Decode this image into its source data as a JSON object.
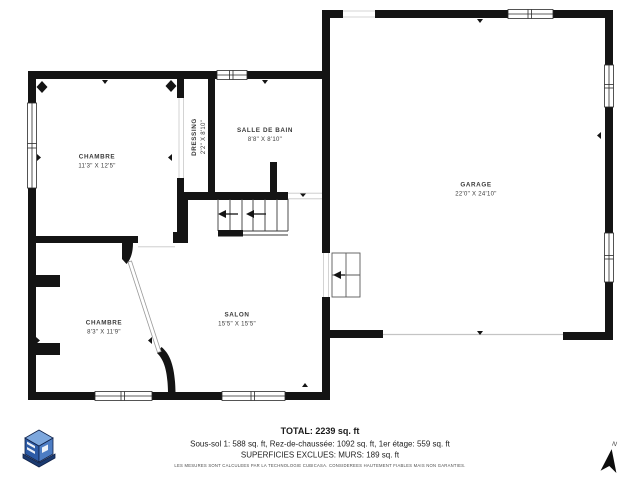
{
  "floorplan": {
    "rooms": [
      {
        "name": "CHAMBRE",
        "dims": "11'3\" X 12'5\""
      },
      {
        "name": "DRESSING",
        "dims": "2'2\" X 8'10\""
      },
      {
        "name": "SALLE DE BAIN",
        "dims": "8'8\" X 8'10\""
      },
      {
        "name": "GARAGE",
        "dims": "22'0\" X 24'10\""
      },
      {
        "name": "CHAMBRE",
        "dims": "8'3\" X 11'9\""
      },
      {
        "name": "SALON",
        "dims": "15'5\" X 15'5\""
      }
    ],
    "compass": {
      "label": "N"
    }
  },
  "footer": {
    "total": "TOTAL: 2239 sq. ft",
    "breakdown": "Sous-sol 1: 588 sq. ft, Rez-de-chaussée: 1092 sq. ft, 1er étage: 559 sq. ft",
    "exclusions": "SUPERFICIES EXCLUES: MURS: 189 sq. ft",
    "disclaimer": "LES MESURES SONT CALCULEES PAR LA TECHNOLOGIE CUBICASA. CONSIDEREES HAUTEMENT FIABLES MAIS NON GARANTIES."
  },
  "colors": {
    "wall": "#141414",
    "label": "#3a3a3a",
    "logo_top": "#7da7dd",
    "logo_left": "#2d5ba6",
    "logo_right": "#4d7dc4",
    "logo_base": "#1b3a70"
  }
}
